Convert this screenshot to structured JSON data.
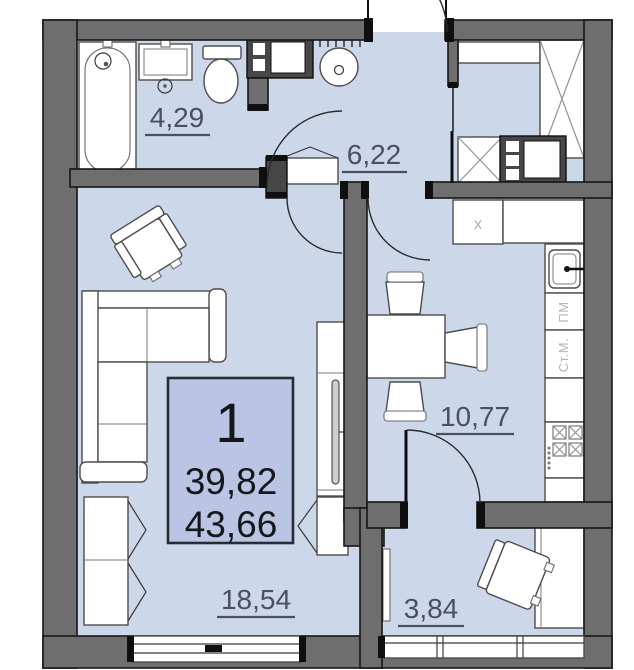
{
  "plan_title": "apartment-floor-plan",
  "info_box": {
    "flat_number": "1",
    "living_area": "39,82",
    "total_area": "43,66"
  },
  "rooms": [
    {
      "id": "bathroom",
      "area_label": "4,29"
    },
    {
      "id": "hallway",
      "area_label": "6,22"
    },
    {
      "id": "kitchen",
      "area_label": "10,77"
    },
    {
      "id": "living-room",
      "area_label": "18,54"
    },
    {
      "id": "balcony",
      "area_label": "3,84"
    }
  ],
  "labels": {
    "dishwasher": "ПМ",
    "washing_machine": "Ст.М.",
    "counter_mark": "x"
  },
  "colors": {
    "floor": "#cdd7ea",
    "wall": "#6e6e6e",
    "info_box_fill": "#b9c5e2",
    "label_text": "#495061",
    "appliance_text": "#b2b5ba"
  }
}
